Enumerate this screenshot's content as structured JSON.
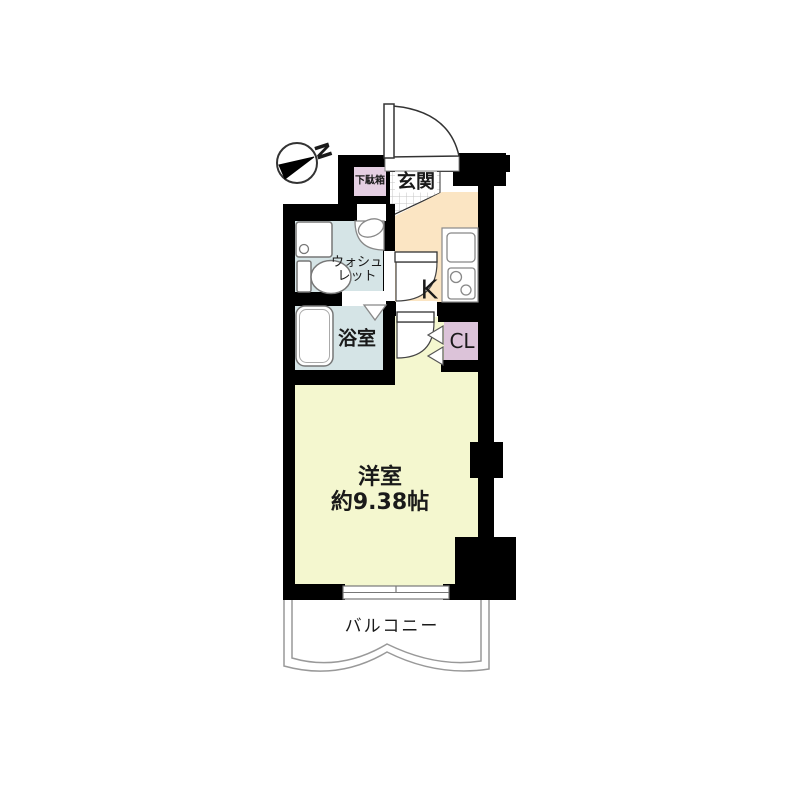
{
  "floorplan": {
    "compass": {
      "north_label": "N"
    },
    "rooms": {
      "getabako": {
        "label": "下駄箱"
      },
      "genkan": {
        "label": "玄関"
      },
      "washlet": {
        "label_line1": "ウォシュ",
        "label_line2": "レット"
      },
      "bathroom": {
        "label": "浴室"
      },
      "kitchen": {
        "label": "K"
      },
      "closet": {
        "label": "CL"
      },
      "main_room": {
        "label": "洋室",
        "size": "約9.38帖"
      },
      "balcony": {
        "label": "バルコニー"
      }
    },
    "colors": {
      "wall": "#000000",
      "genkan_floor": "#ffffff",
      "tile_line": "#c4c4c4",
      "hall_kitchen": "#fbe5c3",
      "wet_rooms": "#d5e4e6",
      "storage": "#e5cfe2",
      "closet": "#dcc3d9",
      "main_room": "#f4f7cf",
      "fixture_fill": "#ffffff",
      "fixture_stroke": "#808080",
      "door_stroke": "#444444",
      "balcony_line": "#999999"
    }
  }
}
